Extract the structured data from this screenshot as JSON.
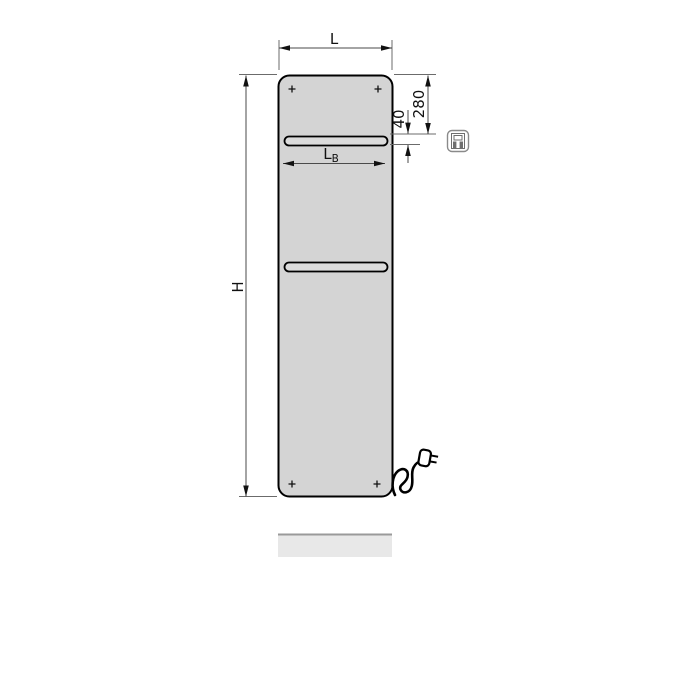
{
  "labels": {
    "width": "L",
    "height": "H",
    "bar_top_offset": "280",
    "bar_thickness": "40",
    "bar_width_main": "L",
    "bar_width_sub": "B"
  },
  "icons": {
    "electric_connection": "electric-plug-icon"
  },
  "colors": {
    "panel_fill": "#d4d4d4",
    "bar_fill": "#dbdbdb",
    "outline": "#000000",
    "dim_line": "#4a4a4a",
    "text": "#111111",
    "floor_fill": "#e8e8e8",
    "floor_edge": "#9a9a9a",
    "icon_stroke": "#8a8a8a",
    "background": "#ffffff"
  }
}
